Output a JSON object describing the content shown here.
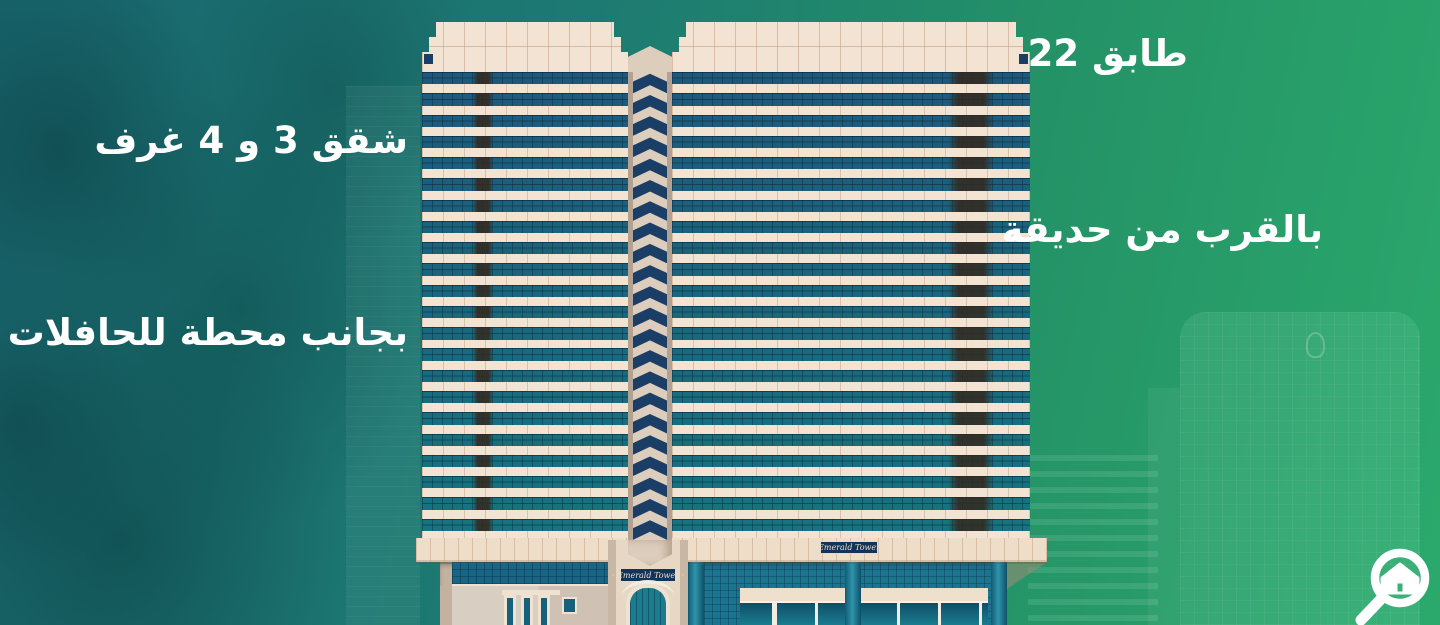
{
  "labels": {
    "floors": "22 طابق",
    "apartments": "شقق 3 و 4 غرف",
    "near_park": "بالقرب من حديقة",
    "near_bus_station": "بجانب محطة للحافلات"
  },
  "building": {
    "sign_center": "· Emerald Tower ·",
    "sign_right": "Emerald Tower",
    "floors_count": 22,
    "colors": {
      "window_top": "#1e597c",
      "window_bottom": "#15747f",
      "facade_cream": "#f3e3d2",
      "chevron_navy": "#1b3e66",
      "column_beige": "#dccdbc",
      "ground_teal": "#1b7490",
      "sign_navy": "#13345a",
      "background_left": "#18646d",
      "background_right": "#2ba96c"
    },
    "wings": [
      {
        "id": "left-wing",
        "left": 422,
        "width": 206,
        "corner": "left",
        "stripes": [
          {
            "left": 51,
            "width": 20
          }
        ]
      },
      {
        "id": "right-wing",
        "left": 672,
        "width": 358,
        "corner": "right",
        "stripes": [
          {
            "left": 276,
            "width": 46
          }
        ]
      }
    ]
  },
  "icons": {
    "logo": "magnifier-house-icon"
  }
}
